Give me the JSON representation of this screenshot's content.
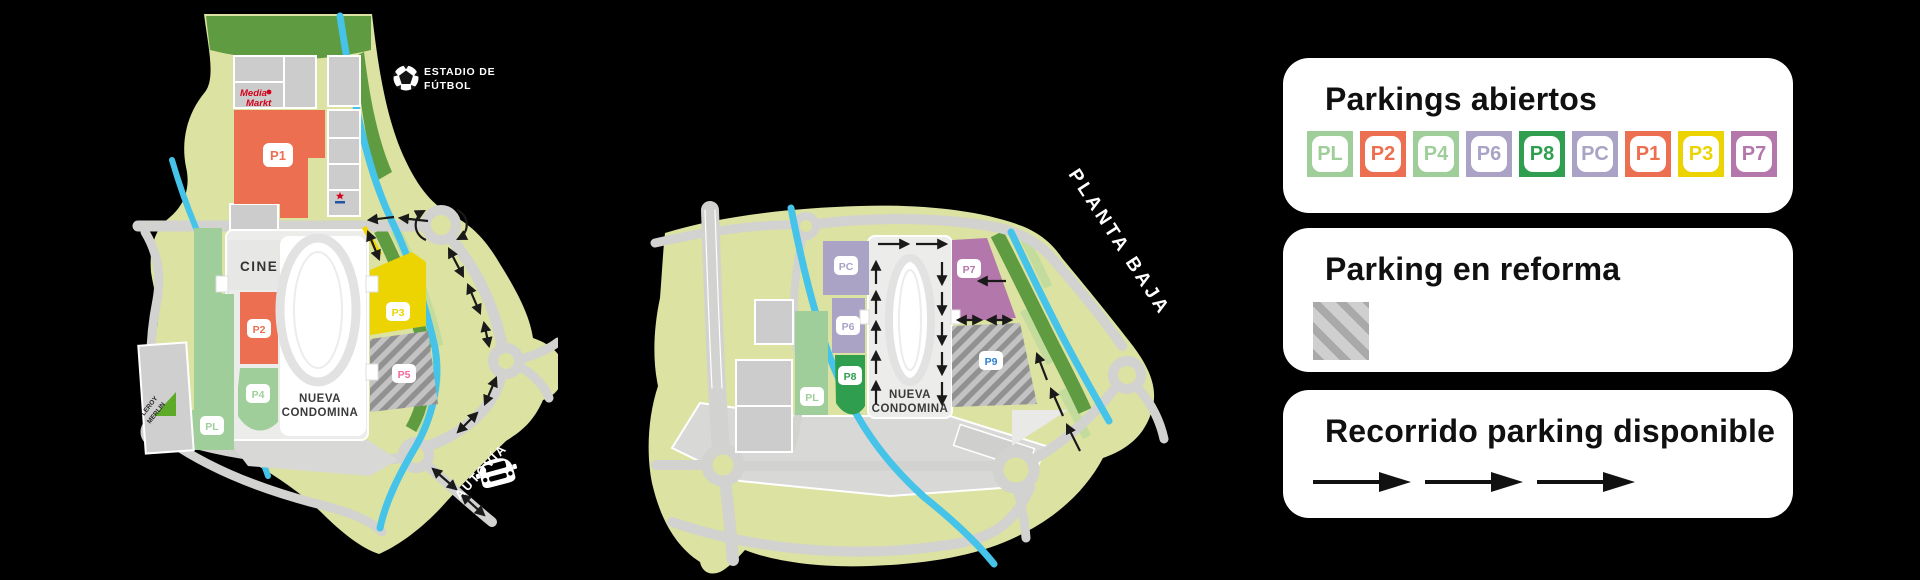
{
  "background": "#000000",
  "palette": {
    "map_base": "#dce2a1",
    "road": "#d2d2d0",
    "river": "#45c3e8",
    "green_dark": "#5f9c41",
    "green_pale": "#c3dc9d",
    "building_gray": "#cccccc",
    "paved_gray": "#e4e4e2",
    "hatch_base": "#c3c3c3",
    "hatch_stripe": "#919191",
    "arrow_black": "#1a1a1a",
    "access_yellow": "#f2d600",
    "media_markt_red": "#d4021c",
    "leroy_merlin_green": "#5daa28",
    "store_logo_blue": "#2255a4"
  },
  "legend": {
    "parkings_abiertos": {
      "title": "Parkings abiertos",
      "badges": [
        {
          "label": "PL",
          "color": "#9fce9a"
        },
        {
          "label": "P2",
          "color": "#ed6f52"
        },
        {
          "label": "P4",
          "color": "#9fce9a"
        },
        {
          "label": "P6",
          "color": "#aaa3c6"
        },
        {
          "label": "P8",
          "color": "#2f9e4f"
        },
        {
          "label": "PC",
          "color": "#aaa3c6"
        },
        {
          "label": "P1",
          "color": "#ed6f52"
        },
        {
          "label": "P3",
          "color": "#ecd403"
        },
        {
          "label": "P7",
          "color": "#b477ab"
        }
      ]
    },
    "parking_reforma": {
      "title": "Parking en reforma"
    },
    "recorrido": {
      "title": "Recorrido parking disponible",
      "arrow_count": 3
    }
  },
  "map_left": {
    "labels": {
      "estadio_line1": "ESTADIO DE",
      "estadio_line2": "FÚTBOL",
      "cine": "CINE",
      "mall_line1": "NUEVA",
      "mall_line2": "CONDOMINA",
      "media_markt_line1": "Media",
      "media_markt_line2": "Markt",
      "leroy_line1": "LEROY",
      "leroy_line2": "MERLIN",
      "autovia": "AUTOVÍA"
    },
    "parkings": [
      {
        "id": "P1",
        "color": "#ed6f52",
        "badge_text": "#ed6f52"
      },
      {
        "id": "P2",
        "color": "#ed6f52",
        "badge_text": "#ed6f52"
      },
      {
        "id": "P4",
        "color": "#9fce9a",
        "badge_text": "#9fce9a"
      },
      {
        "id": "PL",
        "color": "#9fce9a",
        "badge_text": "#9fce9a"
      },
      {
        "id": "P3",
        "color": "#ecd403",
        "badge_text": "#ecd403"
      },
      {
        "id": "P5",
        "color": "hatched",
        "badge_text": "#f2699c"
      }
    ]
  },
  "map_right": {
    "labels": {
      "planta": "PLANTA BAJA",
      "mall_line1": "NUEVA",
      "mall_line2": "CONDOMINA"
    },
    "parkings": [
      {
        "id": "PC",
        "color": "#aaa3c6",
        "badge_text": "#aaa3c6"
      },
      {
        "id": "P6",
        "color": "#aaa3c6",
        "badge_text": "#aaa3c6"
      },
      {
        "id": "P8",
        "color": "#2f9e4f",
        "badge_text": "#2f9e4f"
      },
      {
        "id": "PL",
        "color": "#9fce9a",
        "badge_text": "#9fce9a"
      },
      {
        "id": "P7",
        "color": "#b477ab",
        "badge_text": "#b477ab"
      },
      {
        "id": "P9",
        "color": "hatched",
        "badge_text": "#2e7fd0"
      }
    ]
  }
}
